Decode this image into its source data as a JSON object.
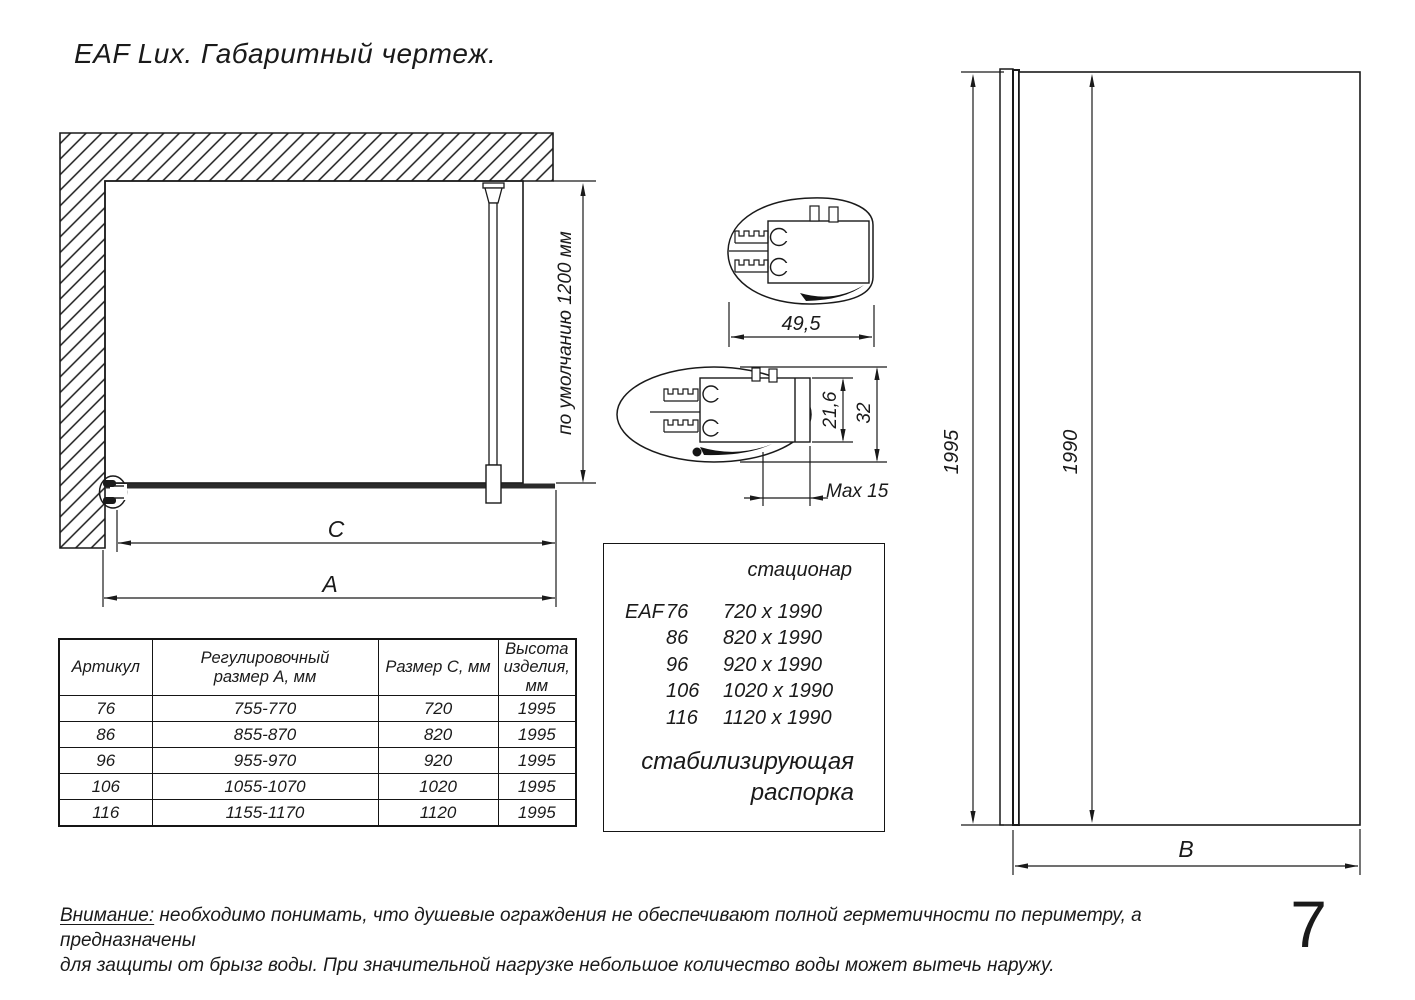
{
  "title": "EAF Lux. Габаритный чертеж.",
  "front_view": {
    "dim_c": "C",
    "dim_a": "A",
    "default_height_label": "по умолчанию 1200 мм"
  },
  "profile_top": {
    "width_label": "49,5"
  },
  "profile_section": {
    "inner_label": "21,6",
    "outer_label": "32",
    "max_label": "Max 15"
  },
  "side_view": {
    "total_height": "1995",
    "glass_height": "1990",
    "width_label": "B"
  },
  "table": {
    "headers": [
      "Артикул",
      "Регулировочный\nразмер А, мм",
      "Размер С, мм",
      "Высота\nизделия,\nмм"
    ],
    "rows": [
      [
        "76",
        "755-770",
        "720",
        "1995"
      ],
      [
        "86",
        "855-870",
        "820",
        "1995"
      ],
      [
        "96",
        "955-970",
        "920",
        "1995"
      ],
      [
        "106",
        "1055-1070",
        "1020",
        "1995"
      ],
      [
        "116",
        "1155-1170",
        "1120",
        "1995"
      ]
    ]
  },
  "legend": {
    "header": "стационар",
    "series": "EAF",
    "rows": [
      [
        "76",
        "720 x 1990"
      ],
      [
        "86",
        "820 x 1990"
      ],
      [
        "96",
        "920 x 1990"
      ],
      [
        "106",
        "1020 x 1990"
      ],
      [
        "116",
        "1120 x 1990"
      ]
    ],
    "footer_line1": "стабилизирующая",
    "footer_line2": "распорка"
  },
  "note": {
    "prefix": "Внимание:",
    "line1_rest": " необходимо понимать, что душевые ограждения не обеспечивают полной герметичности по периметру, а предназначены",
    "line2": "для защиты от брызг воды. При значительной нагрузке небольшое количество воды может вытечь наружу."
  },
  "page_number": "7"
}
